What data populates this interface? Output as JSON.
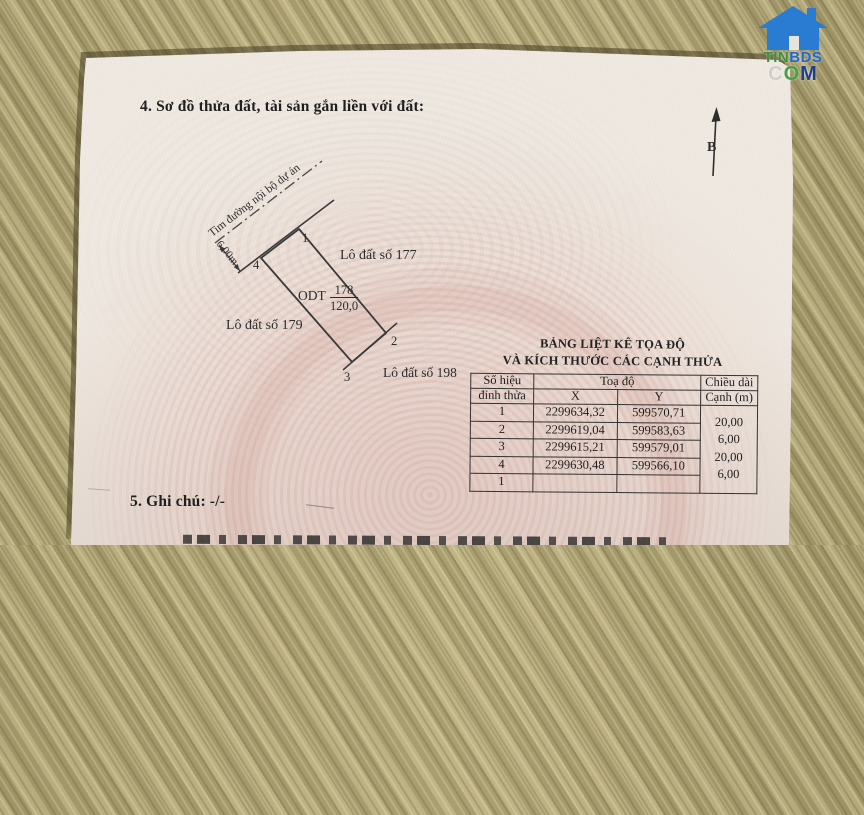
{
  "watermark": {
    "tin": "TIN",
    "bds": "BDS",
    "com_c": "C",
    "com_o": "O",
    "com_m": "M"
  },
  "sections": {
    "diagram_title": "4. Sơ đồ thửa đất, tài sản gắn liền với đất:",
    "notes_title": "5. Ghi chú: -/-"
  },
  "diagram": {
    "north_label": "B",
    "road_centerline_label": "Tim đường nội bộ dự án",
    "road_width_label": "6,00m",
    "vertex_labels": {
      "v1": "1",
      "v2": "2",
      "v3": "3",
      "v4": "4"
    },
    "neighbor_plots": {
      "right": "Lô đất số 177",
      "left": "Lô đất số 179",
      "bottom": "Lô đất số 198"
    },
    "parcel": {
      "land_use_code": "ODT",
      "parcel_number": "178",
      "area_m2": "120,0"
    }
  },
  "table": {
    "title_line1": "BẢNG LIỆT KÊ TỌA ĐỘ",
    "title_line2": "VÀ KÍCH THƯỚC CÁC CẠNH THỬA",
    "headers": {
      "vertex_line1": "Số hiệu",
      "vertex_line2": "đỉnh thửa",
      "coords": "Toạ độ",
      "x": "X",
      "y": "Y",
      "length_line1": "Chiều dài",
      "length_line2": "Cạnh (m)"
    },
    "rows": [
      {
        "id": "1",
        "x": "2299634,32",
        "y": "599570,71"
      },
      {
        "id": "2",
        "x": "2299619,04",
        "y": "599583,63"
      },
      {
        "id": "3",
        "x": "2299615,21",
        "y": "599579,01"
      },
      {
        "id": "4",
        "x": "2299630,48",
        "y": "599566,10"
      },
      {
        "id": "1",
        "x": "",
        "y": ""
      }
    ],
    "edge_lengths": [
      "20,00",
      "6,00",
      "20,00",
      "6,00"
    ]
  }
}
